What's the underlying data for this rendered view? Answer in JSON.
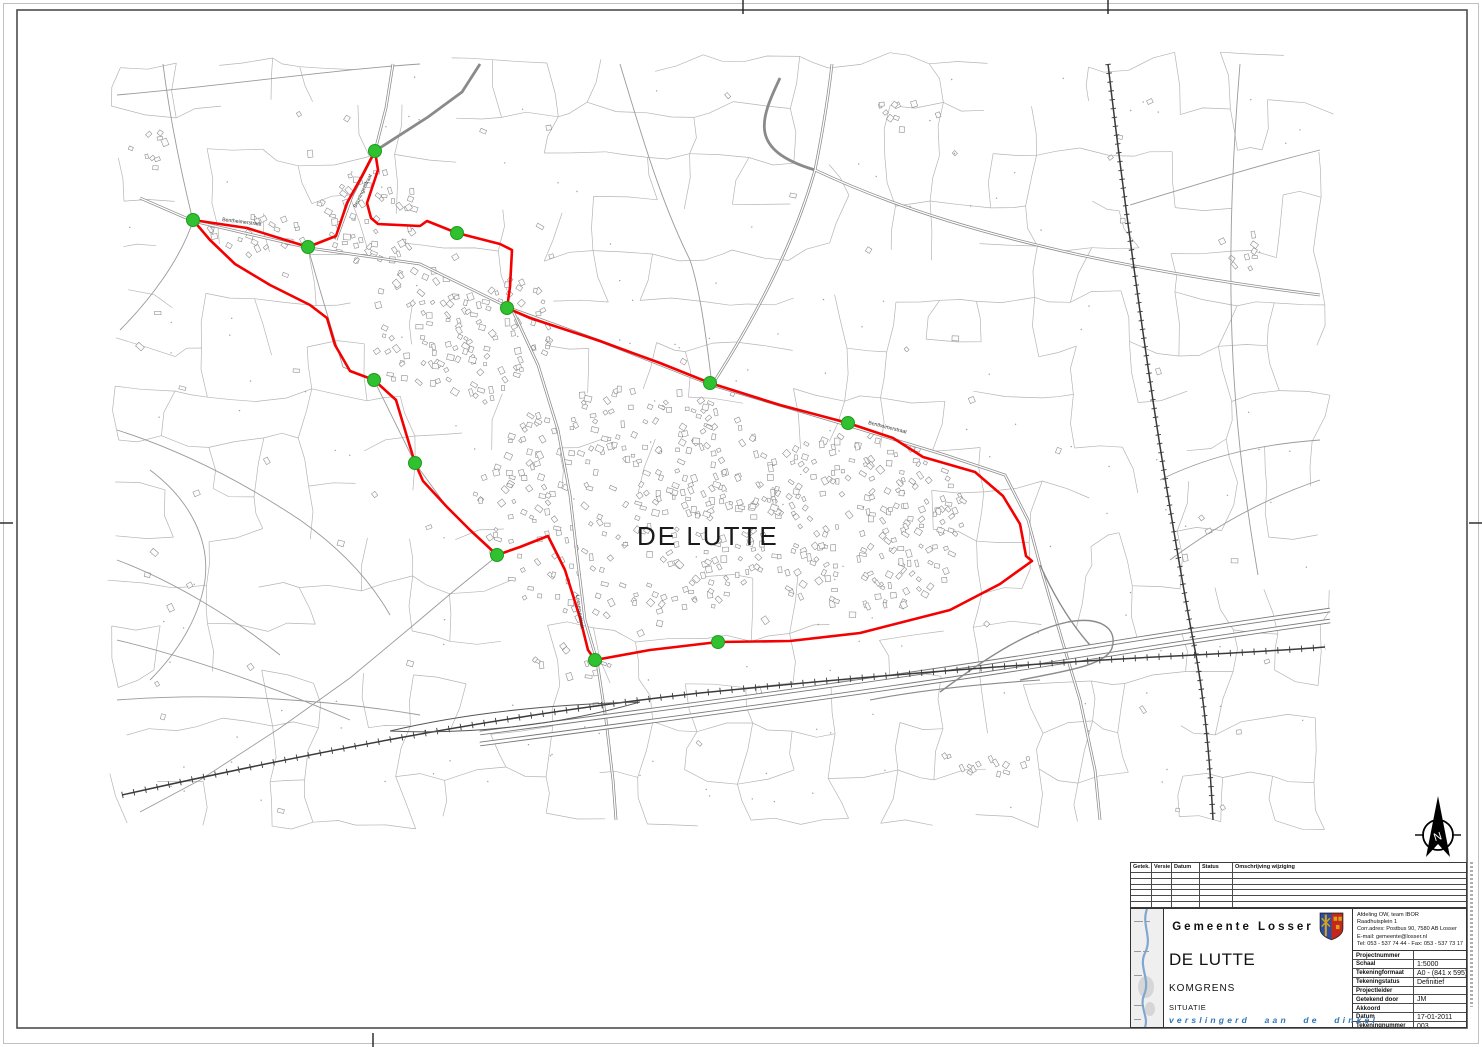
{
  "map": {
    "place_label": "DE LUTTE",
    "road_labels": [
      "Bentheimerstraat",
      "Bentheimerstraat",
      "Lossersestraat",
      "Beuningerstraat"
    ],
    "boundary_color": "#f40000",
    "marker_color": "#2fc12f",
    "compass_letter": "N"
  },
  "revision_table": {
    "headers": [
      "Getek.",
      "Versie",
      "Datum",
      "Status",
      "Omschrijving wijziging"
    ]
  },
  "title_block": {
    "municipality": "Gemeente Losser",
    "department_lines": [
      "Afdeling OW, team IBOR",
      "Raadhuisplein 1",
      "Corr.adres: Postbus 90, 7580 AB Losser",
      "E-mail: gemeente@losser.nl",
      "Tel: 053 - 537 74 44  -  Fax: 053 - 537 73 17"
    ],
    "project_title": "DE LUTTE",
    "project_subject": "KOMGRENS",
    "drawing_type": "SITUATIE",
    "slogan": "verslingerd aan de dinkel",
    "properties": [
      {
        "label": "Projectnummer",
        "value": ""
      },
      {
        "label": "Schaal",
        "value": "1:5000"
      },
      {
        "label": "Tekeningformaat",
        "value": "A0 - (841 x 595)"
      },
      {
        "label": "Tekeningstatus",
        "value": "Definitief"
      },
      {
        "label": "Projectleider",
        "value": ""
      },
      {
        "label": "Getekend door",
        "value": "JM"
      },
      {
        "label": "Akkoord",
        "value": ""
      },
      {
        "label": "Datum",
        "value": "17-01-2011"
      },
      {
        "label": "Tekeningnummer",
        "value": "003"
      }
    ]
  }
}
